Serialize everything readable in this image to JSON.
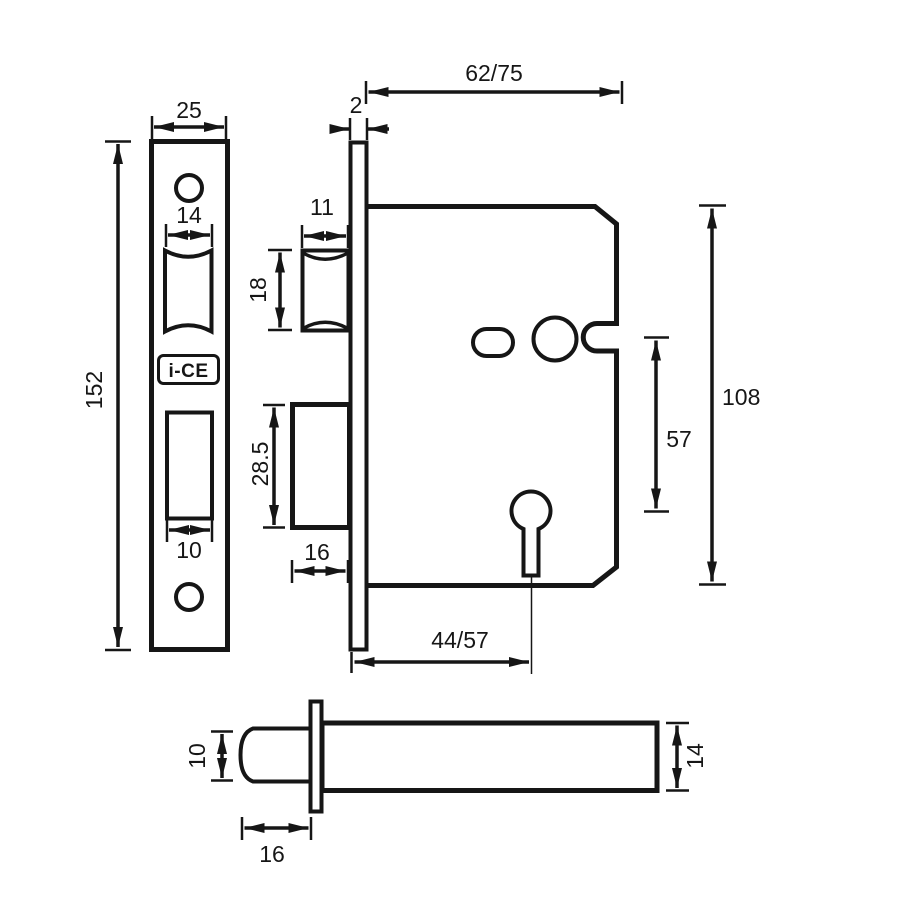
{
  "drawing": {
    "brand": "i-CE",
    "faceplate_front": {
      "width_mm": "25",
      "height_mm": "152",
      "latch_cutout_width_mm": "14",
      "deadbolt_cutout_width_mm": "10"
    },
    "case_side": {
      "faceplate_thickness_mm": "2",
      "case_depth_mm": "62/75",
      "latch_width_mm": "11",
      "latch_height_mm": "18",
      "deadbolt_height_mm": "28.5",
      "deadbolt_throw_mm": "16",
      "case_height_mm": "108",
      "spindle_to_keyhole_mm": "57",
      "backset_mm": "44/57"
    },
    "latchbolt_side": {
      "bolt_height_mm": "10",
      "bolt_throw_mm": "16",
      "case_height_mm": "14"
    }
  }
}
